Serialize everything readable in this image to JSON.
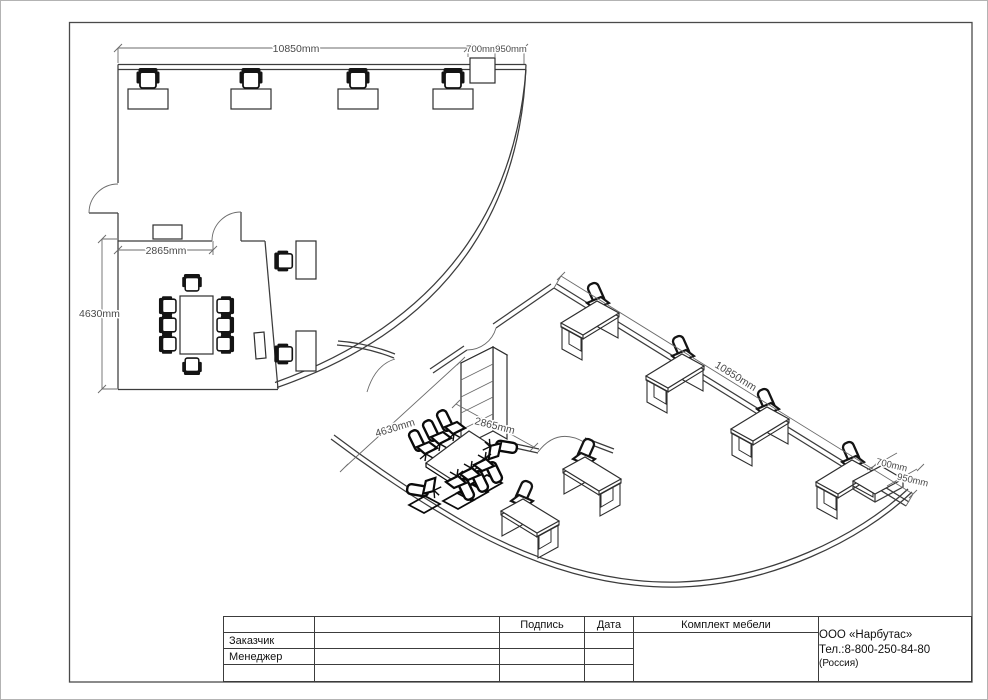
{
  "plan": {
    "dim_total_width": "10850mm",
    "dim_cabinet_depth": "700mm",
    "dim_cabinet_width": "950mm",
    "dim_room_width": "2865mm",
    "dim_room_depth": "4630mm"
  },
  "iso": {
    "dim_total_width": "10850mm",
    "dim_room_depth": "4630mm",
    "dim_room_width": "2865mm",
    "dim_cabinet_depth": "700mm",
    "dim_cabinet_width": "950mm"
  },
  "title_block": {
    "customer_label": "Заказчик",
    "manager_label": "Менеджер",
    "signature_label": "Подпись",
    "date_label": "Дата",
    "project_title": "Комплект мебели",
    "company_name": "ООО «Нарбутас»",
    "company_phone": "Тел.:8-800-250-84-80",
    "company_country": "(Россия)"
  },
  "colors": {
    "background": "#ffffff",
    "line": "#3c3c3c",
    "furniture": "#141414",
    "dim_text": "#4a4a4a"
  }
}
